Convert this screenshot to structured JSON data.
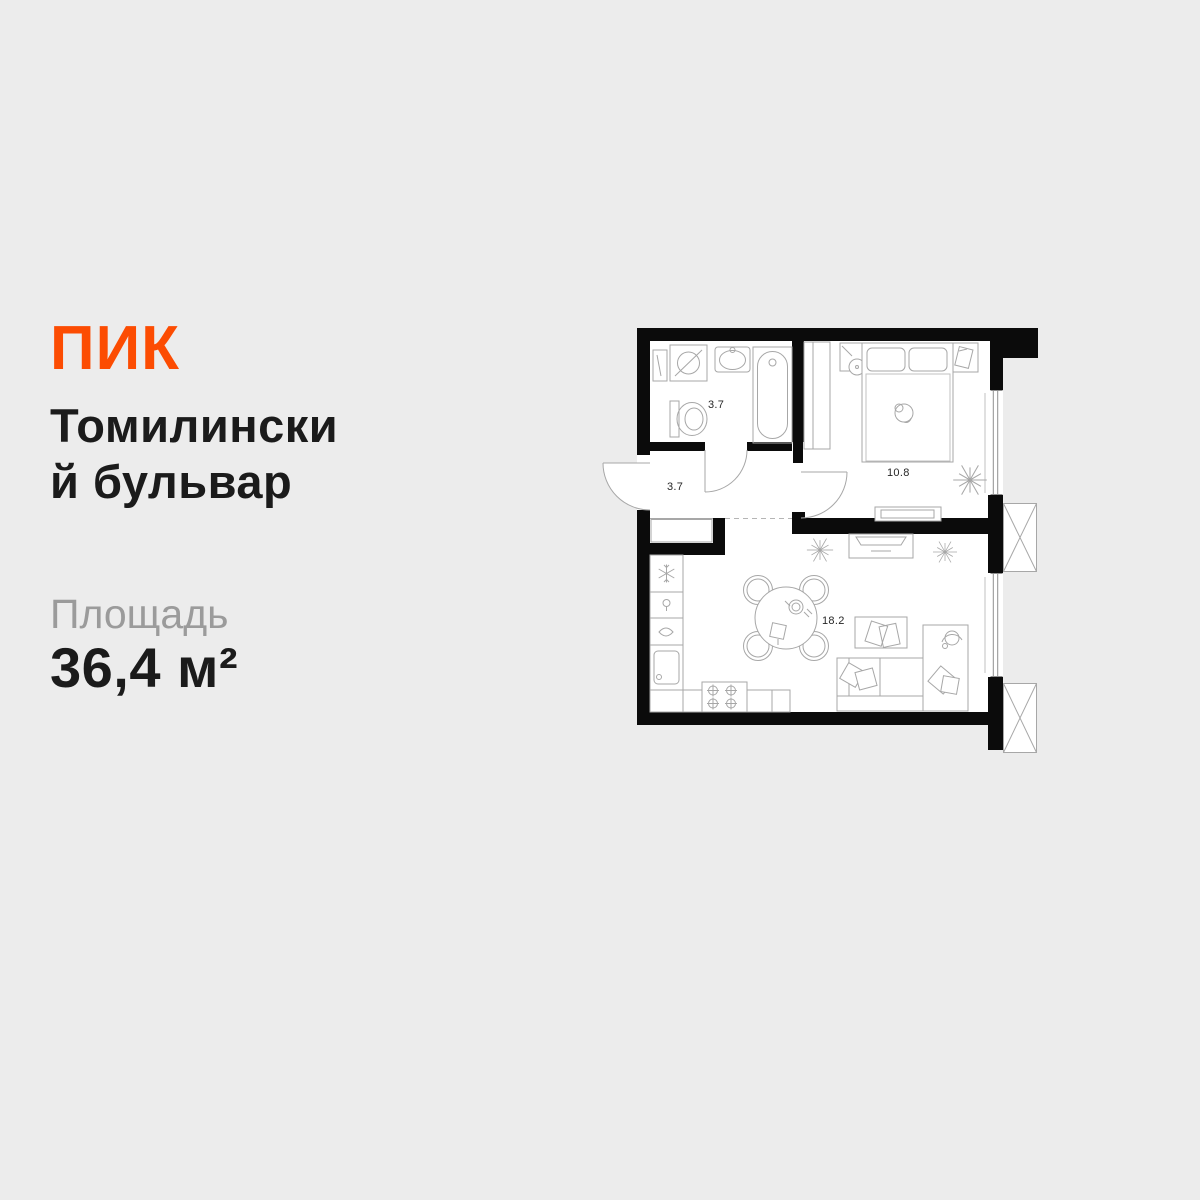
{
  "page": {
    "background_color": "#ECECEC"
  },
  "brand": {
    "name": "ПИК",
    "color": "#FC4C02"
  },
  "listing": {
    "title_line1": "Томилински",
    "title_line2": "й бульвар",
    "area_label": "Площадь",
    "area_value": "36,4 м²"
  },
  "floor_plan": {
    "rooms": [
      {
        "id": "bathroom",
        "area": "3.7"
      },
      {
        "id": "hallway",
        "area": "3.7"
      },
      {
        "id": "bedroom",
        "area": "10.8"
      },
      {
        "id": "living-kitchen",
        "area": "18.2"
      }
    ],
    "colors": {
      "wall": "#0B0B0B",
      "furniture_outline": "#A7A7A7",
      "floor": "#FFFFFF",
      "label": "#262626"
    }
  }
}
